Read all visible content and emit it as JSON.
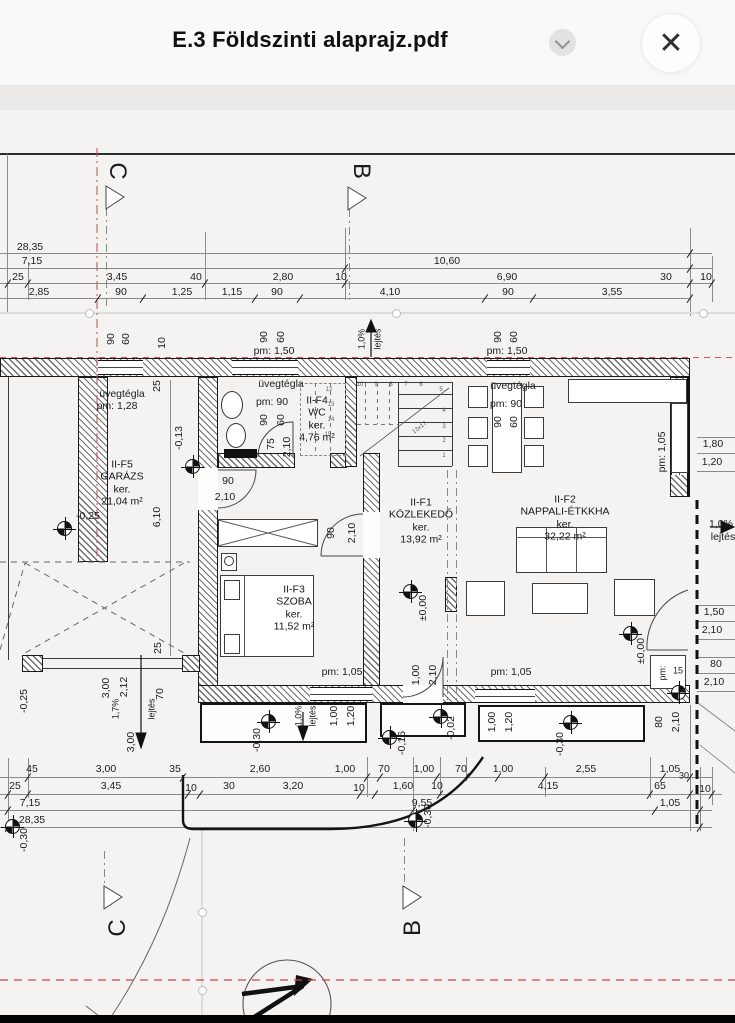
{
  "header": {
    "title": "E.3 Földszinti alaprajz.pdf"
  },
  "icons": {
    "close": "✕",
    "chevron": "chevron-down"
  },
  "colors": {
    "accent_red": "#c0504d",
    "ink": "#1c1c1c",
    "paper": "#f4f3f1"
  },
  "plan": {
    "rooms": [
      {
        "lines": "II-F5\nGARÁZS\nker.\n21,04 m²",
        "x": 122,
        "y": 483
      },
      {
        "lines": "II-F4\nWC\nker.\n4,76 m²",
        "x": 317,
        "y": 419
      },
      {
        "lines": "II-F3\nSZOBA\nker.\n11,52 m²",
        "x": 294,
        "y": 608
      },
      {
        "lines": "II-F1\nKÖZLEKEDŐ\nker.\n13,92 m²",
        "x": 421,
        "y": 521
      },
      {
        "lines": "II-F2\nNAPPALI-ÉTKKHA\nker.\n32,22 m²",
        "x": 565,
        "y": 518
      }
    ],
    "markers": [
      {
        "x": 64,
        "y": 528
      },
      {
        "x": 192,
        "y": 466
      },
      {
        "x": 410,
        "y": 591
      },
      {
        "x": 630,
        "y": 633
      },
      {
        "x": 268,
        "y": 721
      },
      {
        "x": 440,
        "y": 716
      },
      {
        "x": 389,
        "y": 737
      },
      {
        "x": 570,
        "y": 722
      },
      {
        "x": 678,
        "y": 692
      },
      {
        "x": 12,
        "y": 826
      },
      {
        "x": 415,
        "y": 820
      }
    ],
    "labels": [
      {
        "t": "28,35",
        "x": 30,
        "y": 247
      },
      {
        "t": "7,15",
        "x": 32,
        "y": 261
      },
      {
        "t": "10,60",
        "x": 447,
        "y": 261
      },
      {
        "t": "25",
        "x": 18,
        "y": 277
      },
      {
        "t": "3,45",
        "x": 117,
        "y": 277
      },
      {
        "t": "40",
        "x": 196,
        "y": 277
      },
      {
        "t": "2,80",
        "x": 283,
        "y": 277
      },
      {
        "t": "10",
        "x": 341,
        "y": 277
      },
      {
        "t": "6,90",
        "x": 507,
        "y": 277
      },
      {
        "t": "30",
        "x": 666,
        "y": 277
      },
      {
        "t": "10",
        "x": 706,
        "y": 277
      },
      {
        "t": "2,85",
        "x": 39,
        "y": 292
      },
      {
        "t": "90",
        "x": 121,
        "y": 292
      },
      {
        "t": "1,25",
        "x": 182,
        "y": 292
      },
      {
        "t": "1,15",
        "x": 232,
        "y": 292
      },
      {
        "t": "90",
        "x": 277,
        "y": 292
      },
      {
        "t": "4,10",
        "x": 390,
        "y": 292
      },
      {
        "t": "90",
        "x": 508,
        "y": 292
      },
      {
        "t": "3,55",
        "x": 612,
        "y": 292
      },
      {
        "t": "90",
        "x": 111,
        "y": 339,
        "r": -90
      },
      {
        "t": "60",
        "x": 126,
        "y": 339,
        "r": -90
      },
      {
        "t": "10",
        "x": 162,
        "y": 343,
        "r": -90
      },
      {
        "t": "90",
        "x": 264,
        "y": 337,
        "r": -90
      },
      {
        "t": "60",
        "x": 281,
        "y": 337,
        "r": -90
      },
      {
        "t": "pm: 1,50",
        "x": 274,
        "y": 351
      },
      {
        "t": "1,0%",
        "x": 362,
        "y": 339,
        "r": -90,
        "fs": 9
      },
      {
        "t": "lejtés",
        "x": 378,
        "y": 339,
        "r": -90,
        "fs": 9
      },
      {
        "t": "90",
        "x": 498,
        "y": 337,
        "r": -90
      },
      {
        "t": "60",
        "x": 514,
        "y": 337,
        "r": -90
      },
      {
        "t": "pm: 1,50",
        "x": 507,
        "y": 351
      },
      {
        "t": "25",
        "x": 157,
        "y": 386,
        "r": -90
      },
      {
        "t": "üvegtégla",
        "x": 122,
        "y": 394
      },
      {
        "t": "pm: 1,28",
        "x": 117,
        "y": 406
      },
      {
        "t": "üvegtégla",
        "x": 281,
        "y": 384
      },
      {
        "t": "pm: 90",
        "x": 272,
        "y": 402
      },
      {
        "t": "90",
        "x": 264,
        "y": 420,
        "r": -90
      },
      {
        "t": "60",
        "x": 281,
        "y": 420,
        "r": -90
      },
      {
        "t": "üvegtégla",
        "x": 513,
        "y": 386
      },
      {
        "t": "pm: 90",
        "x": 506,
        "y": 404
      },
      {
        "t": "90",
        "x": 498,
        "y": 422,
        "r": -90
      },
      {
        "t": "60",
        "x": 514,
        "y": 422,
        "r": -90
      },
      {
        "t": "75",
        "x": 271,
        "y": 444,
        "r": -90
      },
      {
        "t": "2,10",
        "x": 287,
        "y": 447,
        "r": -90
      },
      {
        "t": "-0,13",
        "x": 179,
        "y": 438,
        "r": -90
      },
      {
        "t": "90",
        "x": 228,
        "y": 481
      },
      {
        "t": "2,10",
        "x": 225,
        "y": 497
      },
      {
        "t": "6,10",
        "x": 157,
        "y": 517,
        "r": -90
      },
      {
        "t": "-0,25",
        "x": 88,
        "y": 516
      },
      {
        "t": "90",
        "x": 331,
        "y": 533,
        "r": -90
      },
      {
        "t": "2,10",
        "x": 352,
        "y": 533,
        "r": -90
      },
      {
        "t": "±0,00",
        "x": 423,
        "y": 608,
        "r": -90
      },
      {
        "t": "±0,00",
        "x": 641,
        "y": 651,
        "r": -90
      },
      {
        "t": "pm: 1,05",
        "x": 662,
        "y": 452,
        "r": -90
      },
      {
        "t": "1,80",
        "x": 713,
        "y": 444
      },
      {
        "t": "1,20",
        "x": 712,
        "y": 462
      },
      {
        "t": "1,0%",
        "x": 721,
        "y": 524
      },
      {
        "t": "lejtés",
        "x": 723,
        "y": 537
      },
      {
        "t": "1,50",
        "x": 714,
        "y": 612
      },
      {
        "t": "2,10",
        "x": 712,
        "y": 630
      },
      {
        "t": "pm:",
        "x": 663,
        "y": 673,
        "r": -90,
        "fs": 9
      },
      {
        "t": "15",
        "x": 678,
        "y": 671,
        "fs": 9
      },
      {
        "t": "80",
        "x": 716,
        "y": 664
      },
      {
        "t": "2,10",
        "x": 714,
        "y": 682
      },
      {
        "t": "pm: 1,05",
        "x": 342,
        "y": 672
      },
      {
        "t": "pm: 1,05",
        "x": 511,
        "y": 672
      },
      {
        "t": "1,00",
        "x": 416,
        "y": 675,
        "r": -90
      },
      {
        "t": "2,10",
        "x": 433,
        "y": 675,
        "r": -90
      },
      {
        "t": "-0,30",
        "x": 257,
        "y": 740,
        "r": -90
      },
      {
        "t": "1,0%",
        "x": 299,
        "y": 716,
        "r": -90,
        "fs": 9
      },
      {
        "t": "lejtés",
        "x": 313,
        "y": 716,
        "r": -90,
        "fs": 9
      },
      {
        "t": "1,00",
        "x": 334,
        "y": 716,
        "r": -90
      },
      {
        "t": "1,20",
        "x": 351,
        "y": 716,
        "r": -90
      },
      {
        "t": "-0,02",
        "x": 451,
        "y": 728,
        "r": -90
      },
      {
        "t": "-0,16",
        "x": 402,
        "y": 743,
        "r": -90
      },
      {
        "t": "1,00",
        "x": 492,
        "y": 722,
        "r": -90
      },
      {
        "t": "1,20",
        "x": 509,
        "y": 722,
        "r": -90
      },
      {
        "t": "-0,30",
        "x": 560,
        "y": 744,
        "r": -90
      },
      {
        "t": "80",
        "x": 659,
        "y": 722,
        "r": -90
      },
      {
        "t": "2,10",
        "x": 676,
        "y": 722,
        "r": -90
      },
      {
        "t": "-0,25",
        "x": 24,
        "y": 701,
        "r": -90
      },
      {
        "t": "1,7%",
        "x": 116,
        "y": 709,
        "r": -90,
        "fs": 9
      },
      {
        "t": "lejtés",
        "x": 152,
        "y": 709,
        "r": -90,
        "fs": 9
      },
      {
        "t": "3,00",
        "x": 106,
        "y": 688,
        "r": -90
      },
      {
        "t": "2,12",
        "x": 124,
        "y": 687,
        "r": -90
      },
      {
        "t": "25",
        "x": 158,
        "y": 648,
        "r": -90
      },
      {
        "t": "70",
        "x": 160,
        "y": 694,
        "r": -90
      },
      {
        "t": "3,00",
        "x": 131,
        "y": 742,
        "r": -90
      },
      {
        "t": "45",
        "x": 32,
        "y": 769
      },
      {
        "t": "3,00",
        "x": 106,
        "y": 769
      },
      {
        "t": "35",
        "x": 175,
        "y": 769
      },
      {
        "t": "2,60",
        "x": 260,
        "y": 769
      },
      {
        "t": "1,00",
        "x": 345,
        "y": 769
      },
      {
        "t": "70",
        "x": 384,
        "y": 769
      },
      {
        "t": "1,00",
        "x": 424,
        "y": 769
      },
      {
        "t": "70",
        "x": 461,
        "y": 769
      },
      {
        "t": "1,00",
        "x": 503,
        "y": 769
      },
      {
        "t": "2,55",
        "x": 586,
        "y": 769
      },
      {
        "t": "1,05",
        "x": 670,
        "y": 769
      },
      {
        "t": "30",
        "x": 684,
        "y": 776,
        "fs": 9
      },
      {
        "t": "25",
        "x": 15,
        "y": 786
      },
      {
        "t": "3,45",
        "x": 111,
        "y": 786
      },
      {
        "t": "10",
        "x": 191,
        "y": 788
      },
      {
        "t": "30",
        "x": 229,
        "y": 786
      },
      {
        "t": "3,20",
        "x": 293,
        "y": 786
      },
      {
        "t": "10",
        "x": 359,
        "y": 788
      },
      {
        "t": "1,60",
        "x": 403,
        "y": 786
      },
      {
        "t": "10",
        "x": 437,
        "y": 786
      },
      {
        "t": "4,15",
        "x": 548,
        "y": 786
      },
      {
        "t": "65",
        "x": 660,
        "y": 786
      },
      {
        "t": "10",
        "x": 705,
        "y": 789
      },
      {
        "t": "7,15",
        "x": 30,
        "y": 803
      },
      {
        "t": "9,55",
        "x": 422,
        "y": 803
      },
      {
        "t": "1,05",
        "x": 670,
        "y": 803
      },
      {
        "t": "28,35",
        "x": 32,
        "y": 820
      },
      {
        "t": "-0,30",
        "x": 24,
        "y": 840,
        "r": -90
      },
      {
        "t": "-0,30",
        "x": 428,
        "y": 816,
        "r": -90
      },
      {
        "t": "C",
        "x": 117,
        "y": 171,
        "r": 90,
        "fs": 24,
        "n": "section-letter-c-top"
      },
      {
        "t": "B",
        "x": 361,
        "y": 171,
        "r": 90,
        "fs": 24,
        "n": "section-letter-b-top"
      },
      {
        "t": "C",
        "x": 118,
        "y": 928,
        "r": -90,
        "fs": 24,
        "n": "section-letter-c-bottom"
      },
      {
        "t": "B",
        "x": 413,
        "y": 928,
        "r": -90,
        "fs": 24,
        "n": "section-letter-b-bottom"
      },
      {
        "t": "1",
        "x": 444,
        "y": 456,
        "fs": 6,
        "c": "#555"
      },
      {
        "t": "2",
        "x": 444,
        "y": 441,
        "fs": 6,
        "c": "#555"
      },
      {
        "t": "3",
        "x": 444,
        "y": 427,
        "fs": 6,
        "c": "#555"
      },
      {
        "t": "4",
        "x": 444,
        "y": 411,
        "fs": 6,
        "c": "#555"
      },
      {
        "t": "5",
        "x": 441,
        "y": 390,
        "fs": 6,
        "c": "#555"
      },
      {
        "t": "6",
        "x": 421,
        "y": 385,
        "fs": 6,
        "c": "#555"
      },
      {
        "t": "7",
        "x": 406,
        "y": 385,
        "fs": 6,
        "c": "#555"
      },
      {
        "t": "8",
        "x": 391,
        "y": 385,
        "fs": 6,
        "c": "#555"
      },
      {
        "t": "9",
        "x": 376,
        "y": 385,
        "fs": 6,
        "c": "#555"
      },
      {
        "t": "10",
        "x": 360,
        "y": 385,
        "fs": 6,
        "c": "#555"
      },
      {
        "t": "12",
        "x": 329,
        "y": 390,
        "fs": 6,
        "c": "#666"
      },
      {
        "t": "13",
        "x": 331,
        "y": 405,
        "fs": 6,
        "c": "#666"
      },
      {
        "t": "14",
        "x": 331,
        "y": 420,
        "fs": 6,
        "c": "#666"
      },
      {
        "t": "15",
        "x": 328,
        "y": 435,
        "fs": 6,
        "c": "#666"
      },
      {
        "t": "13x17",
        "x": 420,
        "y": 428,
        "r": -38,
        "fs": 6,
        "c": "#555"
      }
    ]
  }
}
